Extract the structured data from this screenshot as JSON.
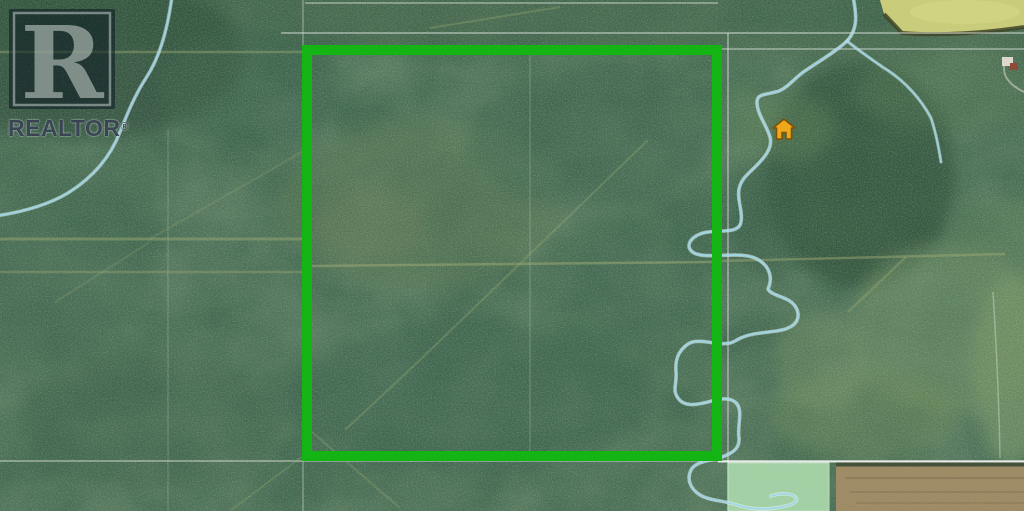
{
  "watermark": {
    "logo_letter": "R",
    "label": "REALTOR",
    "registered": "®"
  },
  "colors": {
    "boundary_green": "#15b415",
    "creek_blue": "#9fd6e8",
    "creek_casing": "#f0fafc",
    "house_marker_fill": "#efa71b",
    "house_marker_outline": "#7c5208",
    "adjacent_parcel_overlay": "#a8d5a9",
    "cultivated_field_tan": "#ab9169",
    "crop_field_yellow": "#c9cc7b",
    "forest_base_green": "#456a52",
    "survey_line_white": "#ffffff",
    "cutline_tan": "#9aa873"
  }
}
